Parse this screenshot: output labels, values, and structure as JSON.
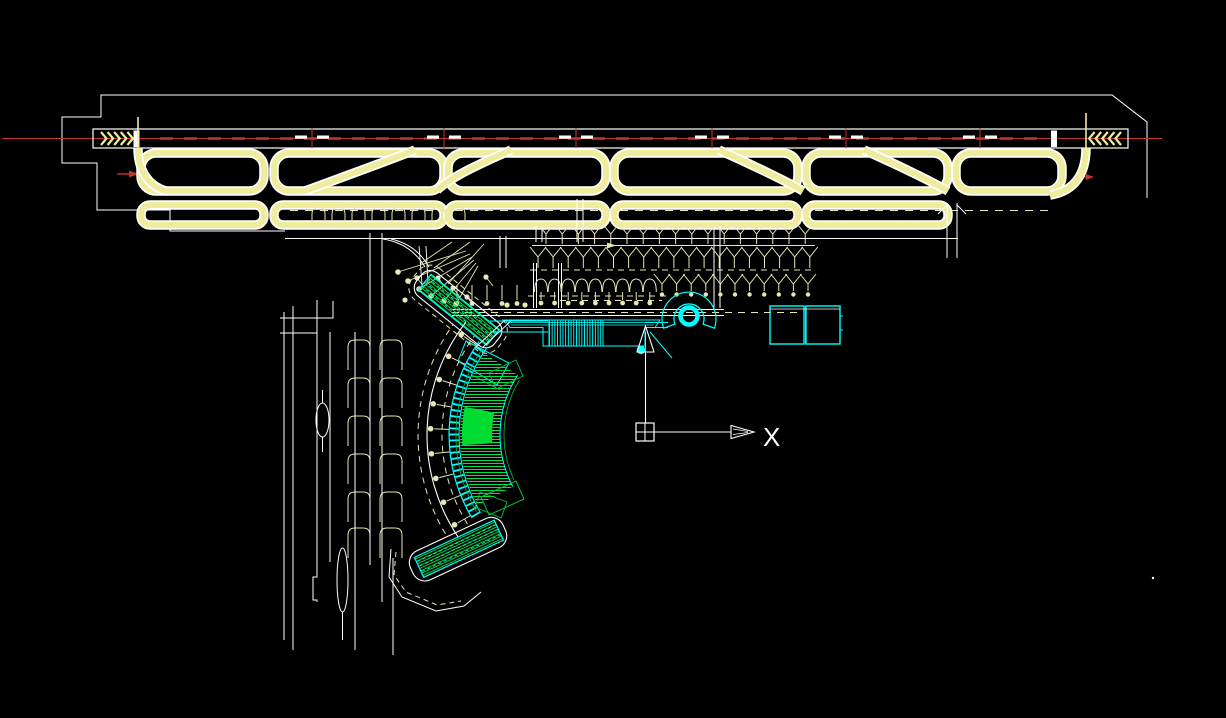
{
  "ucs_icon": {
    "x_axis_label": "X"
  },
  "palette": {
    "background": "#000000",
    "linework_white": "#FFFFFF",
    "taxiway_yellow": "#F0EC9E",
    "apron_cream": "#E9E6B4",
    "runway_red": "#C23430",
    "terminal_cyan": "#00FFFF",
    "terminal_green": "#00E43C",
    "terminal_green_dark": "#00C040",
    "terminal_green_solid": "#00DC32"
  }
}
